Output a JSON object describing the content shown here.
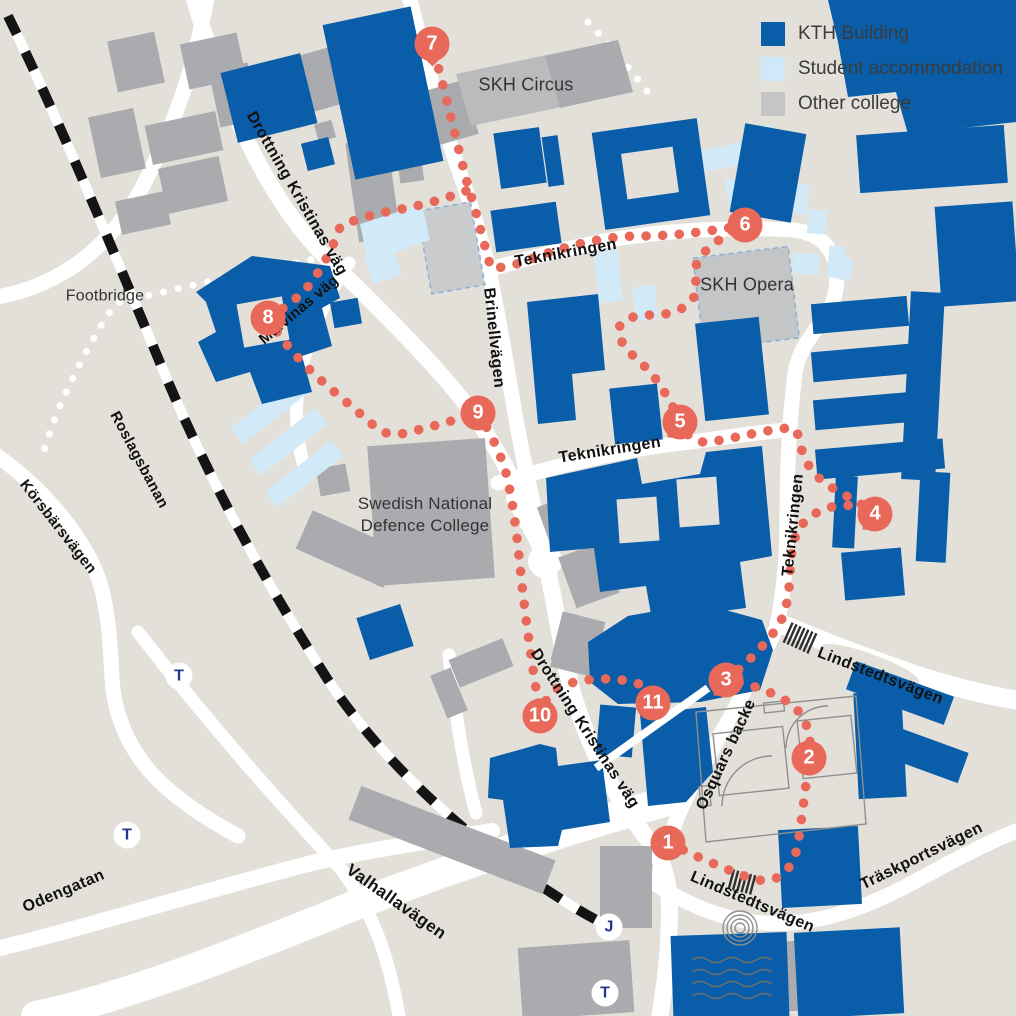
{
  "title": "KTH campus walking-route map",
  "legend": {
    "items": [
      {
        "key": "kth",
        "label": "KTH Building",
        "color": "#0a5da8"
      },
      {
        "key": "student",
        "label": "Student accommodation",
        "color": "#cfe9fa"
      },
      {
        "key": "other",
        "label": "Other college",
        "color": "#c3c5c7"
      }
    ]
  },
  "colors": {
    "background": "#e3e0da",
    "road": "#ffffff",
    "kth_building": "#0a5da8",
    "student_accommodation": "#d2eaf8",
    "other_college": "#a9abae",
    "other_college_light": "#b9bbbd",
    "route": "#e8695a",
    "railway": "#141414",
    "station_letter": "#27348b",
    "dashed_outline": "#8ab1d8",
    "street_label": "#111111",
    "place_label": "#333333",
    "detail_line": "#8f8f8f"
  },
  "map_labels": [
    {
      "id": "footbridge",
      "text": "Footbridge",
      "kind": "place",
      "x": 105,
      "y": 297,
      "rot": 0,
      "size": 16
    },
    {
      "id": "drottning-kristinas-vag-north",
      "text": "Drottning Kristinas väg",
      "kind": "street",
      "x": 296,
      "y": 194,
      "rot": 60,
      "size": 16
    },
    {
      "id": "malvinas-vag",
      "text": "Malvinas väg",
      "kind": "street",
      "x": 299,
      "y": 310,
      "rot": -40,
      "size": 15
    },
    {
      "id": "brinellvagen",
      "text": "Brinellvägen",
      "kind": "street",
      "x": 493,
      "y": 338,
      "rot": 84,
      "size": 16
    },
    {
      "id": "teknikringen-north",
      "text": "Teknikringen",
      "kind": "street",
      "x": 566,
      "y": 254,
      "rot": -10,
      "size": 16
    },
    {
      "id": "skh-circus",
      "text": "SKH Circus",
      "kind": "place",
      "x": 526,
      "y": 85,
      "rot": 0,
      "size": 18
    },
    {
      "id": "skh-opera",
      "text": "SKH Opera",
      "kind": "place",
      "x": 747,
      "y": 285,
      "rot": 0,
      "size": 18
    },
    {
      "id": "roslagsbanan",
      "text": "Roslagsbanan",
      "kind": "street",
      "x": 139,
      "y": 460,
      "rot": 62,
      "size": 15
    },
    {
      "id": "korsbarsvagen",
      "text": "Körsbärsvägen",
      "kind": "street",
      "x": 58,
      "y": 527,
      "rot": 52,
      "size": 15
    },
    {
      "id": "teknikringen-mid",
      "text": "Teknikringen",
      "kind": "street",
      "x": 610,
      "y": 451,
      "rot": -9,
      "size": 16
    },
    {
      "id": "teknikringen-east",
      "text": "Teknikringen",
      "kind": "street",
      "x": 794,
      "y": 525,
      "rot": -84,
      "size": 16
    },
    {
      "id": "defence-college",
      "text": "Swedish National\nDefence College",
      "kind": "place",
      "x": 425,
      "y": 515,
      "rot": 0,
      "size": 17
    },
    {
      "id": "lindstedtsvagen-north",
      "text": "Lindstedtsvägen",
      "kind": "street",
      "x": 880,
      "y": 677,
      "rot": 21,
      "size": 16
    },
    {
      "id": "osquars-backe",
      "text": "Osquars backe",
      "kind": "street",
      "x": 727,
      "y": 755,
      "rot": -65,
      "size": 16
    },
    {
      "id": "drottning-kristinas-vag-south",
      "text": "Drottning Kristinas väg",
      "kind": "street",
      "x": 584,
      "y": 729,
      "rot": 57,
      "size": 16
    },
    {
      "id": "lindstedtsvagen-south",
      "text": "Lindstedtsvägen",
      "kind": "street",
      "x": 752,
      "y": 903,
      "rot": 23,
      "size": 16
    },
    {
      "id": "traskportsvagen",
      "text": "Träskportsvägen",
      "kind": "street",
      "x": 922,
      "y": 857,
      "rot": -26,
      "size": 16
    },
    {
      "id": "valhallavagen",
      "text": "Valhallavägen",
      "kind": "street",
      "x": 396,
      "y": 902,
      "rot": 35,
      "size": 17
    },
    {
      "id": "odengatan",
      "text": "Odengatan",
      "kind": "street",
      "x": 64,
      "y": 892,
      "rot": -23,
      "size": 16
    }
  ],
  "route": {
    "markers": [
      {
        "n": "1",
        "x": 668,
        "y": 843,
        "tail": "none"
      },
      {
        "n": "2",
        "x": 809,
        "y": 758,
        "tail": "none"
      },
      {
        "n": "3",
        "x": 726,
        "y": 680,
        "tail": "bl"
      },
      {
        "n": "4",
        "x": 875,
        "y": 514,
        "tail": "bl"
      },
      {
        "n": "5",
        "x": 680,
        "y": 422,
        "tail": "bl"
      },
      {
        "n": "6",
        "x": 745,
        "y": 225,
        "tail": "none"
      },
      {
        "n": "7",
        "x": 432,
        "y": 44,
        "tail": "b"
      },
      {
        "n": "8",
        "x": 268,
        "y": 318,
        "tail": "none"
      },
      {
        "n": "9",
        "x": 478,
        "y": 413,
        "tail": "none"
      },
      {
        "n": "10",
        "x": 540,
        "y": 716,
        "tail": "none"
      },
      {
        "n": "11",
        "x": 653,
        "y": 703,
        "tail": "none"
      }
    ]
  },
  "stations": [
    {
      "label": "T",
      "x": 179,
      "y": 676
    },
    {
      "label": "T",
      "x": 127,
      "y": 835
    },
    {
      "label": "J",
      "x": 609,
      "y": 927
    },
    {
      "label": "T",
      "x": 605,
      "y": 993
    }
  ]
}
